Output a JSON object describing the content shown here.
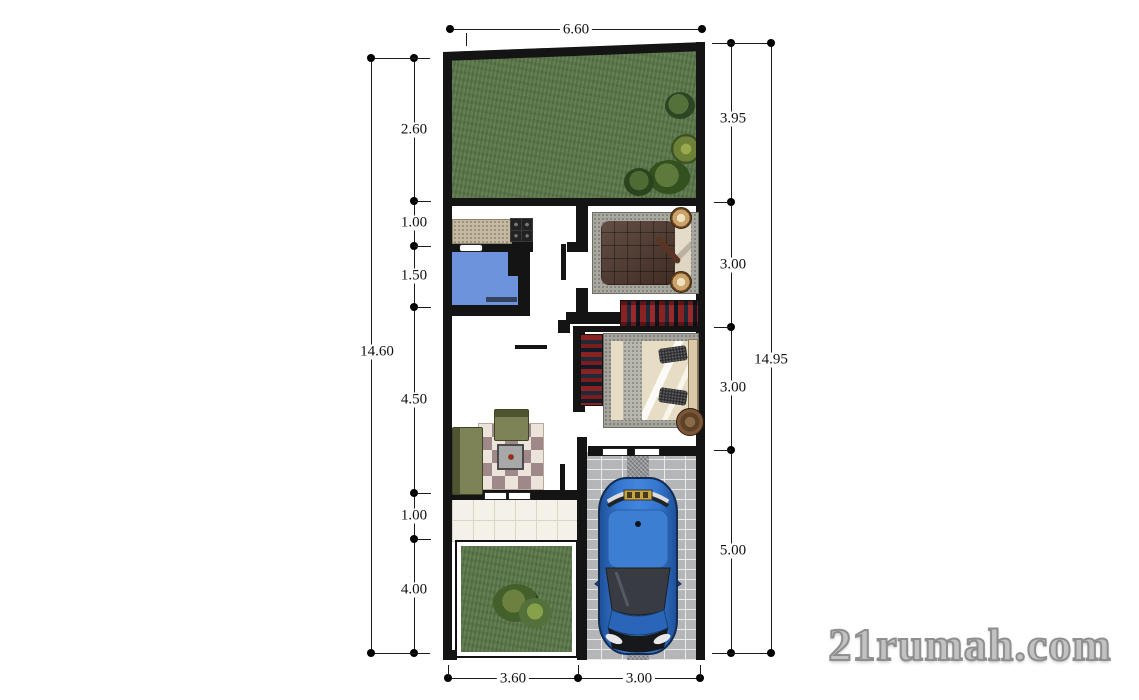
{
  "watermark": {
    "text": "21rumah.com"
  },
  "dims": {
    "top": "6.60",
    "left_total": "14.60",
    "left": [
      "2.60",
      "1.00",
      "1.50",
      "4.50",
      "1.00",
      "4.00"
    ],
    "right_total": "14.95",
    "right": [
      "3.95",
      "3.00",
      "3.00",
      "5.00"
    ],
    "bottom": [
      "3.60",
      "3.00"
    ]
  },
  "colors": {
    "wall": "#141414",
    "grass": "#5e7a4c",
    "bath": "#6d93dd",
    "car": "#2e6fc9",
    "paver": "#b5b6b8",
    "counter": "#c6b9a2",
    "sofa": "#6e7444",
    "rug-mauve": "#9f888a",
    "rug-cream": "#ece4da",
    "bed1-quilt": "#4e362b",
    "watermark": "#c2c2c2"
  }
}
